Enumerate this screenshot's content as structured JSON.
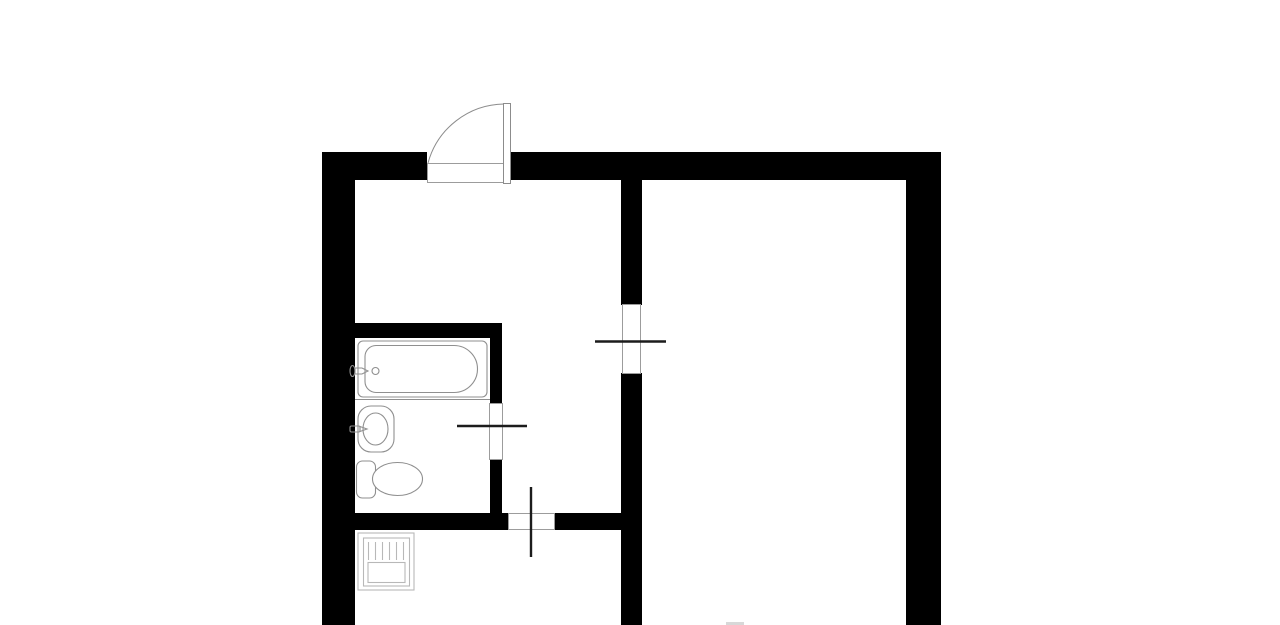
{
  "diagram": {
    "type": "floor-plan",
    "canvas": {
      "width": 1280,
      "height": 625,
      "background": "#ffffff"
    },
    "palette": {
      "wall": "#000000",
      "opening_stroke": "#9c9c9c",
      "leaf": "#1c1c1c",
      "door_stroke": "#8c8c8c",
      "fixture": "#8f8f8f",
      "appliance": "#b8b8b8",
      "faint": "#d8d8d8",
      "white": "#ffffff"
    },
    "groups": [
      {
        "name": "walls",
        "style": {
          "fill": "$wall",
          "stroke": "none"
        },
        "elements": [
          {
            "name": "outer-wall-top-left",
            "tag": "rect",
            "attrs": {
              "x": 322,
              "y": 152,
              "width": 105,
              "height": 28
            }
          },
          {
            "name": "outer-wall-top-right",
            "tag": "rect",
            "attrs": {
              "x": 511,
              "y": 152,
              "width": 430,
              "height": 28
            }
          },
          {
            "name": "outer-wall-left",
            "tag": "rect",
            "attrs": {
              "x": 322,
              "y": 152,
              "width": 33,
              "height": 473
            }
          },
          {
            "name": "outer-wall-right",
            "tag": "rect",
            "attrs": {
              "x": 906,
              "y": 152,
              "width": 35,
              "height": 473
            }
          },
          {
            "name": "partition-wall-upper",
            "tag": "rect",
            "attrs": {
              "x": 621,
              "y": 178,
              "width": 21,
              "height": 127
            }
          },
          {
            "name": "partition-wall-lower",
            "tag": "rect",
            "attrs": {
              "x": 621,
              "y": 373,
              "width": 21,
              "height": 252
            }
          },
          {
            "name": "bathroom-wall-top",
            "tag": "rect",
            "attrs": {
              "x": 355,
              "y": 323,
              "width": 147,
              "height": 15
            }
          },
          {
            "name": "bathroom-wall-right-upper",
            "tag": "rect",
            "attrs": {
              "x": 490,
              "y": 330,
              "width": 12,
              "height": 73
            }
          },
          {
            "name": "bathroom-wall-right-lower",
            "tag": "rect",
            "attrs": {
              "x": 490,
              "y": 460,
              "width": 12,
              "height": 55
            }
          },
          {
            "name": "bottom-wall-left-of-door",
            "tag": "rect",
            "attrs": {
              "x": 355,
              "y": 513,
              "width": 153,
              "height": 17
            }
          },
          {
            "name": "bottom-wall-right-of-door",
            "tag": "rect",
            "attrs": {
              "x": 555,
              "y": 513,
              "width": 67,
              "height": 17
            }
          }
        ]
      },
      {
        "name": "doorways",
        "style": {
          "fill": "$white",
          "stroke": "$opening_stroke",
          "stroke-width": 1
        },
        "elements": [
          {
            "name": "entrance-doorway-sill",
            "tag": "rect",
            "attrs": {
              "x": 427.5,
              "y": 163.5,
              "width": 83,
              "height": 19
            }
          },
          {
            "name": "partition-doorway",
            "tag": "rect",
            "attrs": {
              "x": 622.5,
              "y": 304.5,
              "width": 18,
              "height": 69
            }
          },
          {
            "name": "bathroom-doorway",
            "tag": "rect",
            "attrs": {
              "x": 489.5,
              "y": 403.5,
              "width": 13,
              "height": 56
            }
          },
          {
            "name": "hall-doorway",
            "tag": "rect",
            "attrs": {
              "x": 508.5,
              "y": 513.5,
              "width": 46,
              "height": 16
            }
          }
        ]
      },
      {
        "name": "entrance-door",
        "style": {
          "fill": "none",
          "stroke": "$door_stroke",
          "stroke-width": 1
        },
        "elements": [
          {
            "name": "entrance-door-swing-arc",
            "tag": "path",
            "attrs": {
              "d": "M 428 163 A 80 80 0 0 1 504 104"
            }
          },
          {
            "name": "entrance-door-panel",
            "tag": "rect",
            "attrs": {
              "x": 503.5,
              "y": 103.5,
              "width": 7,
              "height": 80,
              "fill": "$white"
            }
          }
        ]
      },
      {
        "name": "door-leaves",
        "style": {
          "fill": "none",
          "stroke": "$leaf",
          "stroke-width": 2.4
        },
        "elements": [
          {
            "name": "partition-door-leaf",
            "tag": "line",
            "attrs": {
              "x1": 595,
              "y1": 341.5,
              "x2": 666,
              "y2": 341.5
            }
          },
          {
            "name": "bathroom-door-leaf",
            "tag": "line",
            "attrs": {
              "x1": 457,
              "y1": 426,
              "x2": 527,
              "y2": 426
            }
          },
          {
            "name": "hall-door-leaf",
            "tag": "line",
            "attrs": {
              "x1": 531,
              "y1": 487,
              "x2": 531,
              "y2": 557
            }
          }
        ]
      },
      {
        "name": "bathroom-fixtures",
        "style": {
          "fill": "none",
          "stroke": "$fixture",
          "stroke-width": 1.1
        },
        "elements": [
          {
            "name": "bathtub-rim",
            "tag": "rect",
            "attrs": {
              "x": 358,
              "y": 341,
              "width": 129,
              "height": 56,
              "rx": 5
            }
          },
          {
            "name": "bathtub-basin",
            "tag": "path",
            "attrs": {
              "d": "M 376 345.5 L 454 345.5 A 23.5 23.5 0 0 1 454 392.5 L 376 392.5 A 11 11 0 0 1 365 381.5 L 365 356.5 A 11 11 0 0 1 376 345.5 Z"
            }
          },
          {
            "name": "bathtub-drain",
            "tag": "circle",
            "attrs": {
              "cx": 375.5,
              "cy": 371,
              "r": 3.5
            }
          },
          {
            "name": "bathtub-faucet-handle",
            "tag": "ellipse",
            "attrs": {
              "cx": 352.5,
              "cy": 371,
              "rx": 2.5,
              "ry": 5.5
            }
          },
          {
            "name": "bathtub-faucet-spout",
            "tag": "path",
            "attrs": {
              "d": "M 355 368 L 362 368 L 368 371 L 362 374 L 355 374 Z"
            }
          },
          {
            "name": "bathtub-apron-line",
            "tag": "line",
            "attrs": {
              "x1": 355,
              "y1": 399.5,
              "x2": 490,
              "y2": 399.5
            }
          },
          {
            "name": "sink-rim",
            "tag": "rect",
            "attrs": {
              "x": 358,
              "y": 406,
              "width": 36,
              "height": 46,
              "rx": 13
            }
          },
          {
            "name": "sink-basin",
            "tag": "ellipse",
            "attrs": {
              "cx": 375.5,
              "cy": 429,
              "rx": 12.5,
              "ry": 16
            }
          },
          {
            "name": "sink-faucet-base",
            "tag": "rect",
            "attrs": {
              "x": 350,
              "y": 426,
              "width": 10,
              "height": 6,
              "rx": 1.5
            }
          },
          {
            "name": "sink-faucet-spout",
            "tag": "path",
            "attrs": {
              "d": "M 360 426.5 L 367 429 L 360 431.5 Z"
            }
          },
          {
            "name": "toilet-tank",
            "tag": "rect",
            "attrs": {
              "x": 356.5,
              "y": 461,
              "width": 19,
              "height": 37,
              "rx": 6
            }
          },
          {
            "name": "toilet-bowl",
            "tag": "ellipse",
            "attrs": {
              "cx": 397.5,
              "cy": 479,
              "rx": 25,
              "ry": 16.5,
              "fill": "$white"
            }
          }
        ]
      },
      {
        "name": "kitchen-fixtures",
        "style": {
          "fill": "none",
          "stroke": "$appliance",
          "stroke-width": 1.1
        },
        "elements": [
          {
            "name": "stove-body",
            "tag": "rect",
            "attrs": {
              "x": 358,
              "y": 533,
              "width": 56,
              "height": 57
            }
          },
          {
            "name": "stove-top",
            "tag": "rect",
            "attrs": {
              "x": 363.5,
              "y": 538,
              "width": 46,
              "height": 48
            }
          },
          {
            "name": "stove-grill-line-1",
            "tag": "line",
            "attrs": {
              "x1": 368.5,
              "y1": 542,
              "x2": 368.5,
              "y2": 560
            }
          },
          {
            "name": "stove-grill-line-2",
            "tag": "line",
            "attrs": {
              "x1": 375.5,
              "y1": 542,
              "x2": 375.5,
              "y2": 560
            }
          },
          {
            "name": "stove-grill-line-3",
            "tag": "line",
            "attrs": {
              "x1": 382.5,
              "y1": 542,
              "x2": 382.5,
              "y2": 560
            }
          },
          {
            "name": "stove-grill-line-4",
            "tag": "line",
            "attrs": {
              "x1": 389.5,
              "y1": 542,
              "x2": 389.5,
              "y2": 560
            }
          },
          {
            "name": "stove-grill-line-5",
            "tag": "line",
            "attrs": {
              "x1": 396.5,
              "y1": 542,
              "x2": 396.5,
              "y2": 560
            }
          },
          {
            "name": "stove-grill-line-6",
            "tag": "line",
            "attrs": {
              "x1": 403.5,
              "y1": 542,
              "x2": 403.5,
              "y2": 560
            }
          },
          {
            "name": "stove-drawer",
            "tag": "rect",
            "attrs": {
              "x": 368,
              "y": 562.5,
              "width": 37,
              "height": 20
            }
          }
        ]
      },
      {
        "name": "misc",
        "style": {
          "fill": "$faint",
          "stroke": "none"
        },
        "elements": [
          {
            "name": "partial-object-edge",
            "tag": "rect",
            "attrs": {
              "x": 726,
              "y": 622,
              "width": 18,
              "height": 3
            }
          }
        ]
      }
    ]
  }
}
